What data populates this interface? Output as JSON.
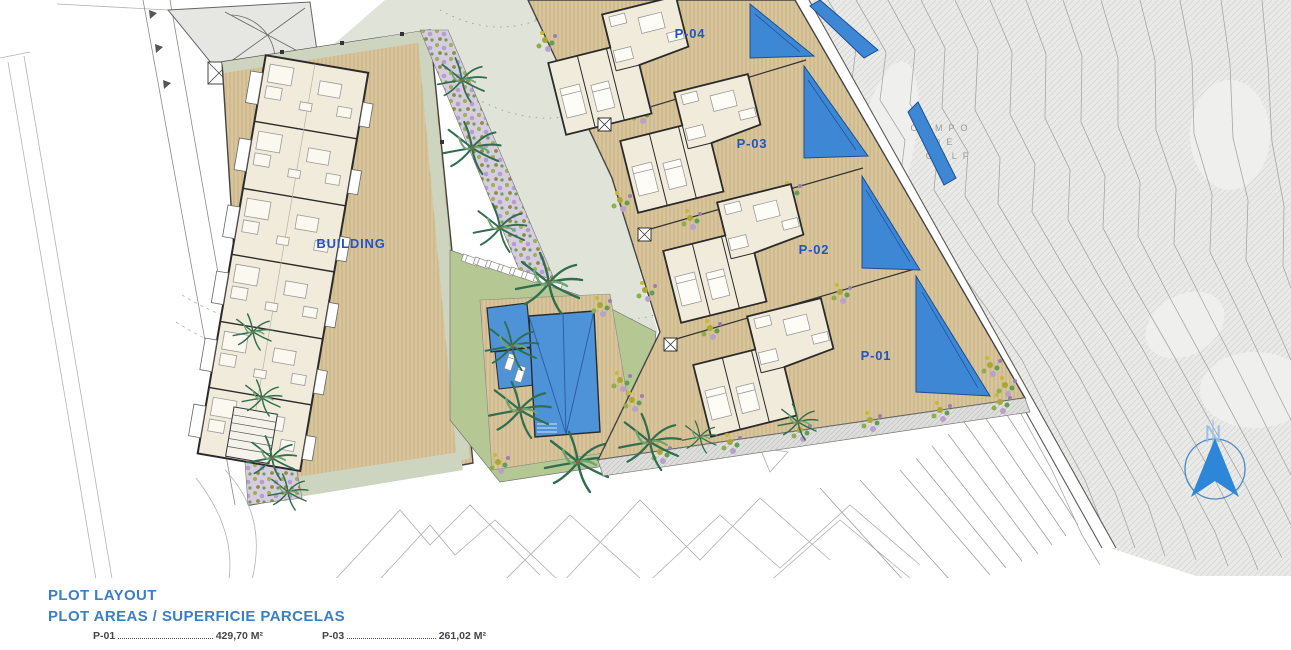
{
  "plan": {
    "building_label": "BUILDING",
    "plot_labels": {
      "p01": "P-01",
      "p02": "P-02",
      "p03": "P-03",
      "p04": "P-04"
    },
    "golf": {
      "line1": "CAMPO",
      "line2": "DE",
      "line3": "GOLF"
    },
    "north_label": "N"
  },
  "legend": {
    "title1": "PLOT LAYOUT",
    "title2": "PLOT AREAS / SUPERFICIE PARCELAS",
    "rows": [
      {
        "label": "P-01",
        "value": "429,70 M²"
      },
      {
        "label": "P-03",
        "value": "261,02 M²"
      }
    ]
  },
  "colors": {
    "label_blue": "#2353c5",
    "title_blue": "#3b7fc4",
    "pool_blue": "#4e92d8",
    "north_blue": "#2e86d8",
    "terrace_tan": "#d8c59b",
    "lawn_green": "#b5c893",
    "golf_gray": "#eaeae8"
  }
}
